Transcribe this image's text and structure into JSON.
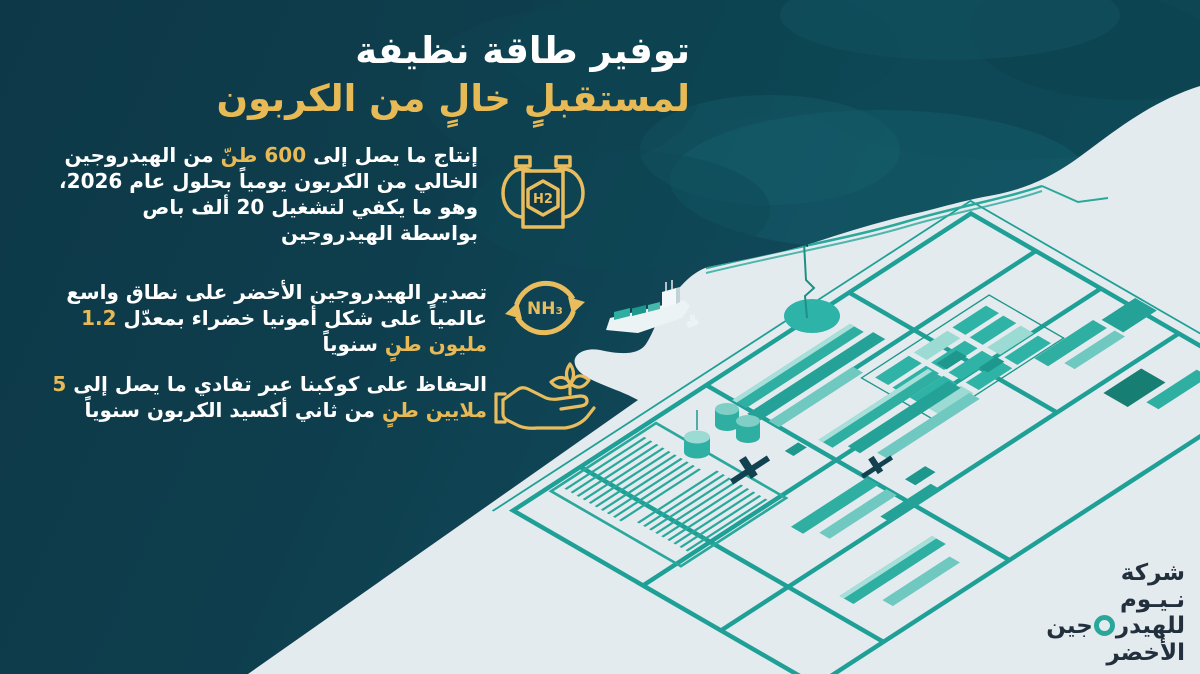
{
  "title": {
    "line1": "توفير طاقة نظيفة",
    "line2": "لمستقبلٍ خالٍ من الكربون"
  },
  "bullets": [
    {
      "icon": "hydrogen-tanks-icon",
      "icon_text": "H2",
      "segments": [
        {
          "t": "إنتاج ما يصل إلى ",
          "hl": false
        },
        {
          "t": "600 طنّ",
          "hl": true
        },
        {
          "t": " من الهيدروجين الخالي من الكربون يومياً بحلول عام 2026، وهو ما يكفي لتشغيل 20 ألف باص بواسطة الهيدروجين",
          "hl": false
        }
      ]
    },
    {
      "icon": "ammonia-cycle-icon",
      "icon_text": "NH₃",
      "segments": [
        {
          "t": "تصدير الهيدروجين الأخضر على نطاق واسع عالمياً على شكل أمونيا خضراء بمعدّل ",
          "hl": false
        },
        {
          "t": "1.2 مليون طنٍ",
          "hl": true
        },
        {
          "t": " سنوياً",
          "hl": false
        }
      ]
    },
    {
      "icon": "hand-plant-icon",
      "icon_text": "",
      "segments": [
        {
          "t": "الحفاظ على كوكبنا عبر تفادي ما يصل إلى ",
          "hl": false
        },
        {
          "t": "5 ملايين طنٍ",
          "hl": true
        },
        {
          "t": " من ثاني أكسيد الكربون سنوياً",
          "hl": false
        }
      ]
    }
  ],
  "logo": {
    "line1": "شركة",
    "line2": "نـيـوم",
    "line3_right": "للهيدر",
    "line3_left": "جين",
    "line4": "الأخضر"
  },
  "colors": {
    "background_navy": "#0E3B4A",
    "sea_teal": "#114E5C",
    "land_light": "#E4EBEF",
    "accent_gold": "#E8BA55",
    "map_teal": "#2AA79B",
    "logo_navy": "#22303E",
    "text_white": "#FFFFFF"
  },
  "illustration": {
    "labels": [
      "sea",
      "coastline",
      "green-hydrogen-plant-site-map",
      "solar-panel-array",
      "warehouse-buildings",
      "storage-tanks",
      "pipeline",
      "flare-pond",
      "cargo-ship",
      "tug-boat"
    ]
  }
}
